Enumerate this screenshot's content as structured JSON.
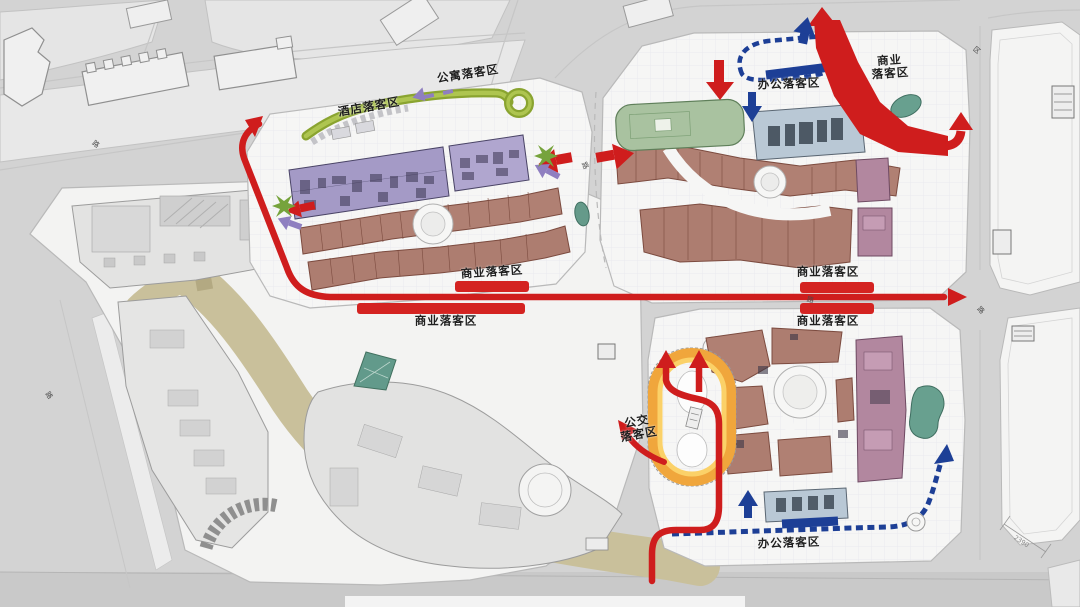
{
  "zones": {
    "apartment": "公寓落客区",
    "hotel": "酒店落客区",
    "office_north": "办公落客区",
    "commercial_ne_l1": "商业",
    "commercial_ne_l2": "落客区",
    "commercial_w_upper": "商业落客区",
    "commercial_w_lower": "商业落客区",
    "commercial_e_upper": "商业落客区",
    "commercial_e_lower": "商业落客区",
    "bus_l1": "公交",
    "bus_l2": "落客区",
    "office_south": "办公落客区"
  },
  "road_labels": {
    "r1": "路",
    "r2": "路",
    "r3": "路",
    "r4": "路",
    "r5": "路",
    "r6": "区"
  },
  "annotations": {
    "dimension": "2390"
  },
  "routes": [
    {
      "name": "vehicular-main-loop",
      "color": "#cf1d1d",
      "style": "solid"
    },
    {
      "name": "office-vip-loop",
      "color": "#1d3f96",
      "style": "dashed"
    },
    {
      "name": "hotel-apartment-loop",
      "color": "#9db63c",
      "style": "solid"
    },
    {
      "name": "bus-loop",
      "color": "#f0a63c",
      "style": "solid"
    },
    {
      "name": "secondary-access",
      "color": "#8f7fc0",
      "style": "arrow"
    }
  ],
  "colors": {
    "route_red": "#cf1d1d",
    "route_blue": "#1d3f96",
    "route_green": "#9db63c",
    "route_yellow": "#f0a63c",
    "route_purple": "#8f7fc0",
    "dropoff_band_red": "#d42321",
    "pedestrian_spine_tan": "#c9c09b",
    "retail_brown": "#b08073",
    "residential_purple": "#a49ac6",
    "office_lightblue": "#b9c8d5",
    "landscape_teal": "#68a08f",
    "anchor_mauve": "#b2879f",
    "parcel_white": "#f6f6f5",
    "road_gray": "#d3d3d3"
  }
}
